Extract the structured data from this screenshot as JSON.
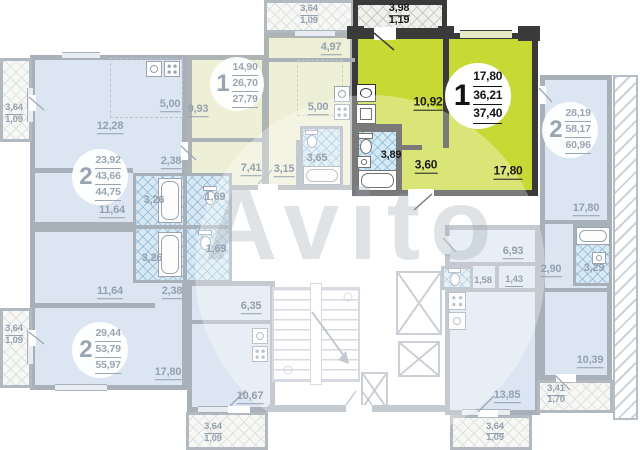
{
  "watermark": "Avito",
  "units": {
    "highlighted": {
      "badge": "1",
      "living": "17,80",
      "area": "36,21",
      "total": "37,40"
    },
    "top_mid": {
      "badge": "1",
      "living": "14,90",
      "area": "26,70",
      "total": "27,79"
    },
    "upper_left": {
      "badge": "2",
      "living": "23,92",
      "area": "43,66",
      "total": "44,75"
    },
    "lower_left": {
      "badge": "2",
      "living": "29,44",
      "area": "53,79",
      "total": "55,97"
    },
    "right": {
      "badge": "2",
      "living": "28,19",
      "area": "58,17",
      "total": "60,96"
    }
  },
  "rooms": {
    "hl_balc_a": "3,98",
    "hl_balc_b": "1,19",
    "hl_kitchen": "10,92",
    "hl_bath": "3,89",
    "hl_hall": "3,60",
    "hl_room": "17,80",
    "tm_balc_a": "3,64",
    "tm_balc_b": "1,09",
    "tm_corridor": "4,97",
    "tm_left": "9,93",
    "tm_kitchen": "5,00",
    "tm_bath": "3,65",
    "tm_hall": "3,15",
    "tm_corr2": "7,41",
    "ul_balc_a": "3,64",
    "ul_balc_b": "1,09",
    "ul_room1": "12,28",
    "ul_kitchen": "5,00",
    "ul_corr": "2,38",
    "ul_bath": "3,26",
    "ul_wc": "1,69",
    "ul_room2": "11,64",
    "ll_wc": "1,69",
    "ll_bath": "3,26",
    "ll_room1": "11,64",
    "ll_corr": "2,38",
    "ll_small": "6,35",
    "ll_room2": "17,80",
    "ll_balc_a": "3,64",
    "ll_balc_b": "1,09",
    "ll_kitchen": "10,67",
    "ll_balc2_a": "3,64",
    "ll_balc2_b": "1,09",
    "r_room1": "17,80",
    "r_hall": "2,90",
    "r_bath": "3,29",
    "r_corr": "6,93",
    "r_wc": "1,58",
    "r_c2": "1,43",
    "r_kitchen": "13,85",
    "r_room2": "10,39",
    "r_balc_a": "3,41",
    "r_balc_b": "1,70",
    "r_balc2_a": "3,64",
    "r_balc2_b": "1,09"
  }
}
